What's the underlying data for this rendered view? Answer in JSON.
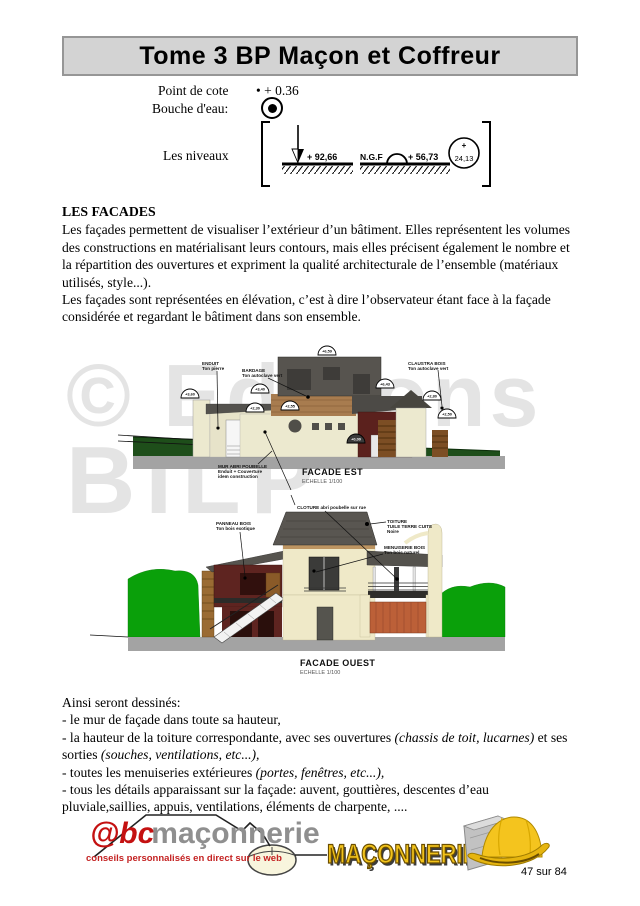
{
  "header": {
    "title": "Tome 3 BP Maçon et Coffreur"
  },
  "legend": {
    "point_de_cote_label": "Point de cote",
    "point_de_cote_value": "• + 0.36",
    "bouche_eau_label": "Bouche d'eau:",
    "niveaux_label": "Les niveaux",
    "niveau1_value": "+ 92,66",
    "ngf_label": "N.G.F",
    "niveau2_value": "+ 56,73",
    "circle_plus": "+",
    "circle_value": "24,13"
  },
  "facades": {
    "heading": "LES FACADES",
    "para1": "Les façades permettent de visualiser l’extérieur d’un bâtiment. Elles représentent les volumes des constructions en matérialisant leurs contours, mais elles précisent également le nombre et la répartition des ouvertures et expriment la qualité architecturale de l’ensemble (matériaux utilisés, style...).",
    "para2": "Les façades sont représentées en élévation, c’est à dire l’observateur étant face à la façade considérée et regardant le bâtiment dans son ensemble."
  },
  "watermark": {
    "line1": "© Editions",
    "line2": "BILP"
  },
  "facade_est": {
    "title": "FACADE EST",
    "scale": "ECHELLE 1/100",
    "label_enduit_1": "ENDUIT",
    "label_enduit_2": "Ton pierre",
    "label_bardage_1": "BARDAGE",
    "label_bardage_2": "Ton autoclave vert",
    "label_claustra_1": "CLAUSTRA BOIS",
    "label_claustra_2": "Ton autoclave vert",
    "label_mur_1": "MUR ABRI POUBELLE",
    "label_mur_2": "Enduit + Couverture",
    "label_mur_3": "idem construction",
    "elevations": {
      "top": "+6,59",
      "right_roof": "+6,43",
      "left": "+3,60",
      "mid_left": "+3,40",
      "low_left": "+2,30",
      "low_mid": "+2,55",
      "tower": "+2,80",
      "far_right": "+2,50",
      "ground": "+0,00"
    }
  },
  "facade_ouest": {
    "title": "FACADE OUEST",
    "scale": "ECHELLE 1/100",
    "label_cloture": "CLOTURE abri poubelle sur rue",
    "label_toiture_1": "TOITURE",
    "label_toiture_2": "TUILE TERRE CUITE",
    "label_toiture_3": "Noire",
    "label_panneau_1": "PANNEAU BOIS",
    "label_panneau_2": "Ton bois exotique",
    "label_menuiserie_1": "MENUISERIE BOIS",
    "label_menuiserie_2": "Ton bois naturel"
  },
  "conclusion": {
    "intro": "Ainsi seront dessinés:",
    "b1": "- le mur de façade dans toute sa hauteur,",
    "b2a": "- la hauteur de la toiture correspondante, avec ses ouvertures ",
    "b2b": "(chassis de toit, lucarnes)",
    "b2c": " et ses sorties ",
    "b2d": "(souches, ventilations, etc...),",
    "b3a": "- toutes les menuiseries extérieures ",
    "b3b": "(portes, fenêtres, etc...),",
    "b4": "- tous les détails apparaissant sur la façade: auvent, gouttières, descentes d’eau pluviale,saillies, appuis, ventilations, éléments de charpente, ...."
  },
  "footer": {
    "logo_at": "@bc",
    "logo_name": "maçonnerie",
    "logo_tagline": "conseils personnalisés en direct sur le web",
    "maconnerie_text": "MAÇONNERIE",
    "page_number": "47 sur 84"
  },
  "colors": {
    "title_bar_bg": "#d3d3d3",
    "watermark": "#e4e4e4",
    "logo_red": "#c41111",
    "logo_gray": "#8f8f8f",
    "maconnerie_yellow": "#f2c31b",
    "grass_bright": "#0aa00a",
    "grass_dark": "#1e4e1a",
    "wall_cream": "#ece9cf",
    "roof_gray": "#57544f",
    "wood_red": "#5b211d",
    "bardage_brown": "#a87c4f",
    "fence_orange": "#bc6038"
  }
}
